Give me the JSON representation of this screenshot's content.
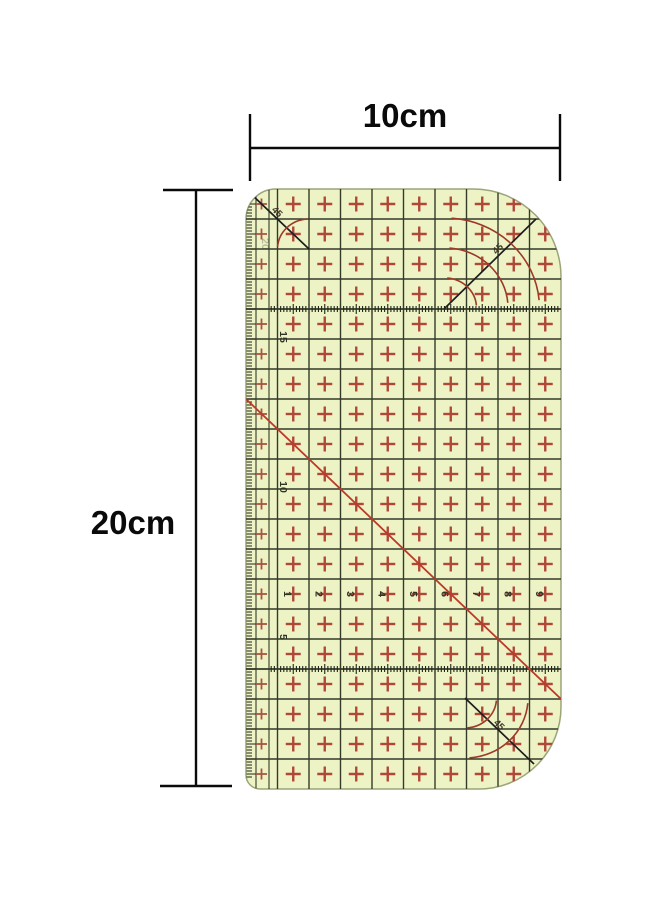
{
  "dimensions": {
    "width_label": "10cm",
    "height_label": "20cm"
  },
  "ruler": {
    "horizontal_scale_numbers": [
      "1",
      "2",
      "3",
      "4",
      "5",
      "6",
      "7",
      "8",
      "9"
    ],
    "vertical_scale_numbers": [
      {
        "label": "20",
        "faint": true
      },
      {
        "label": "15",
        "faint": false
      },
      {
        "label": "10",
        "faint": false
      },
      {
        "label": "5",
        "faint": false
      }
    ],
    "angle_labels": {
      "top_left": "45",
      "top_right": "45",
      "bottom_right": "45"
    },
    "colors": {
      "body": "#eef3c6",
      "edge": "#9aa578",
      "grid": "#333b28",
      "tick": "#20261a",
      "cross": "#b04838",
      "small_cross": "#a85440",
      "bias_line": "#bb3b28",
      "arc": "#9c3a28",
      "marking": "#1d1d1d",
      "number": "#2f3524",
      "angle_label": "#3c3424",
      "dimension": "#0a0a0a"
    }
  }
}
